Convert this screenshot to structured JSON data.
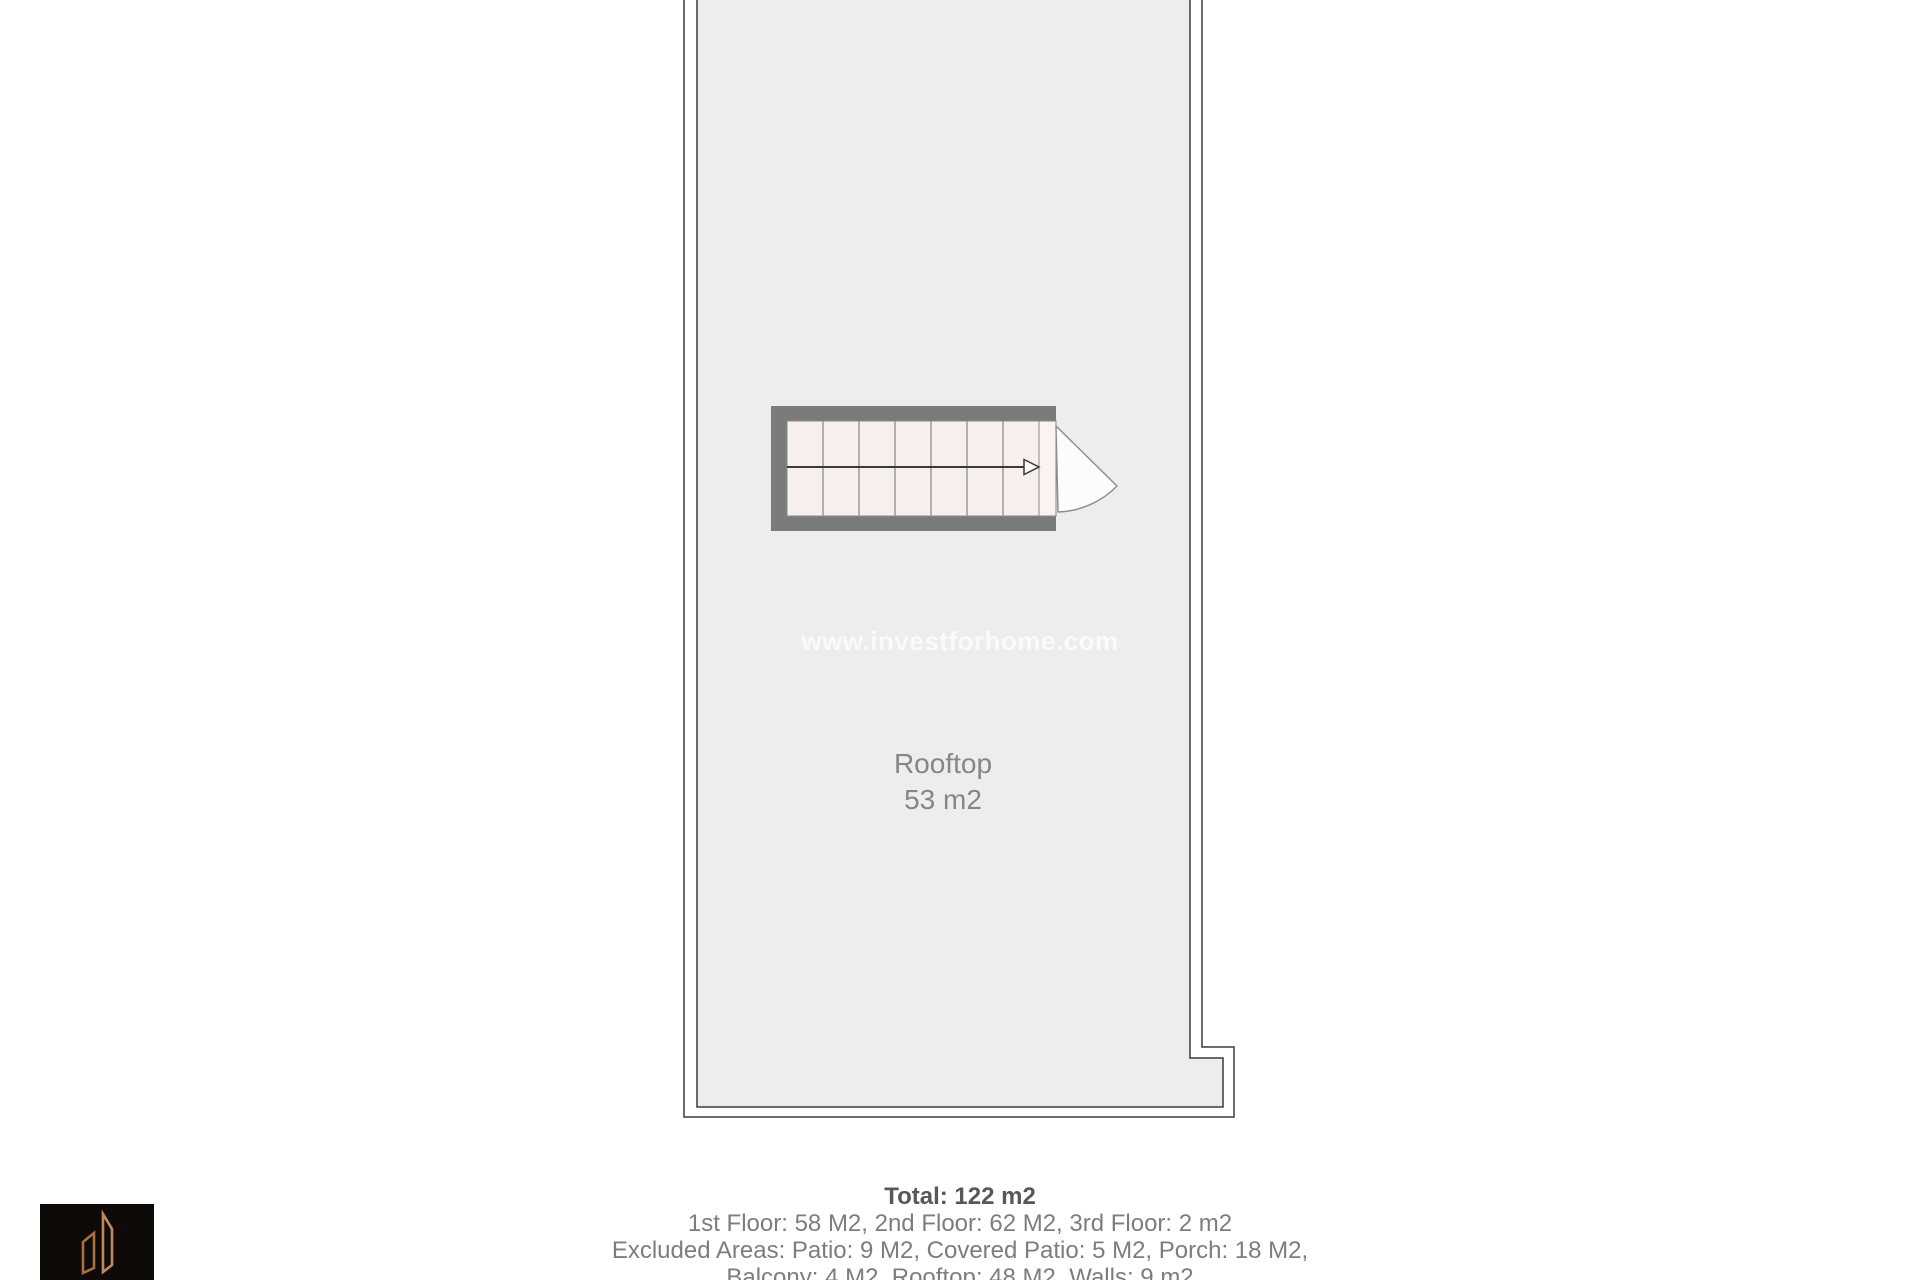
{
  "watermark": {
    "text": "www.investforhome.com",
    "color": "#fafafa"
  },
  "floor_plan": {
    "room_label": "Rooftop",
    "room_area": "53 m2",
    "stairs": {
      "tread_columns": 7,
      "arrow_icon": "stair-direction-arrow-right",
      "door_icon": "door-swing-right"
    },
    "colors": {
      "floor_fill": "#ededec",
      "outline": "#3c3c3c",
      "stair_wall": "#7b7b7b",
      "stair_tread": "#f6efeb",
      "stair_landing": "#faf3ef",
      "tread_divider": "#9b9b9b",
      "arrow": "#3a3a3a",
      "door_line": "#8f8f8f",
      "door_swing_fill": "#fcfcfc",
      "room_label": "#868686"
    }
  },
  "summary": {
    "total": "Total: 122 m2",
    "lines": [
      "1st Floor: 58 M2, 2nd Floor: 62 M2, 3rd Floor: 2 m2",
      "Excluded Areas: Patio: 9 M2, Covered Patio: 5 M2, Porch: 18 M2,",
      "Balcony: 4 M2, Rooftop: 48 M2, Walls: 9 m2"
    ],
    "total_color": "#585858",
    "text_color": "#7d7d7d"
  },
  "logo": {
    "name": "investforhome-logo",
    "background": "#0d0a08",
    "accent_color": "#c08a5a",
    "accent_color_dark": "#a96f3f"
  }
}
